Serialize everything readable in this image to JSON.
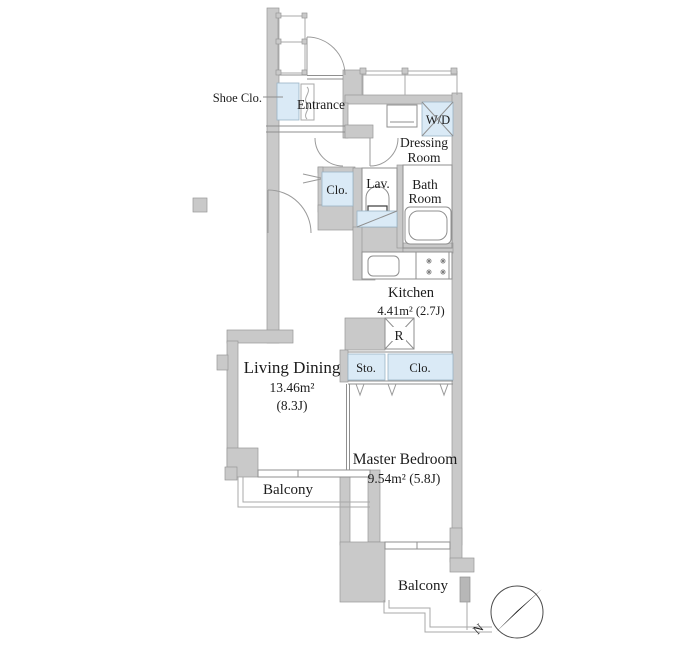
{
  "colors": {
    "wall": "#c9c9c9",
    "closet_blue": "#daeaf6",
    "line": "#8f8f8f",
    "text": "#1c1c1c"
  },
  "rooms": {
    "entrance": {
      "name": "Entrance"
    },
    "shoe_closet": {
      "name": "Shoe Clo."
    },
    "washer_dryer": {
      "name": "W/D"
    },
    "dressing_room": {
      "name_line1": "Dressing",
      "name_line2": "Room"
    },
    "hall_closet": {
      "name": "Clo."
    },
    "lavatory": {
      "name": "Lav."
    },
    "bathroom": {
      "name_line1": "Bath",
      "name_line2": "Room"
    },
    "kitchen": {
      "name": "Kitchen",
      "area": "4.41m² (2.7J)"
    },
    "refrigerator_space": {
      "name": "R"
    },
    "storage": {
      "name": "Sto."
    },
    "bedroom_closet": {
      "name": "Clo."
    },
    "living_dining": {
      "name": "Living Dining",
      "area": "13.46m²",
      "tatami": "(8.3J)"
    },
    "master_bedroom": {
      "name": "Master Bedroom",
      "area": "9.54m² (5.8J)"
    },
    "balcony_living": {
      "name": "Balcony"
    },
    "balcony_bedroom": {
      "name": "Balcony"
    }
  },
  "compass": {
    "north_label": "N"
  }
}
